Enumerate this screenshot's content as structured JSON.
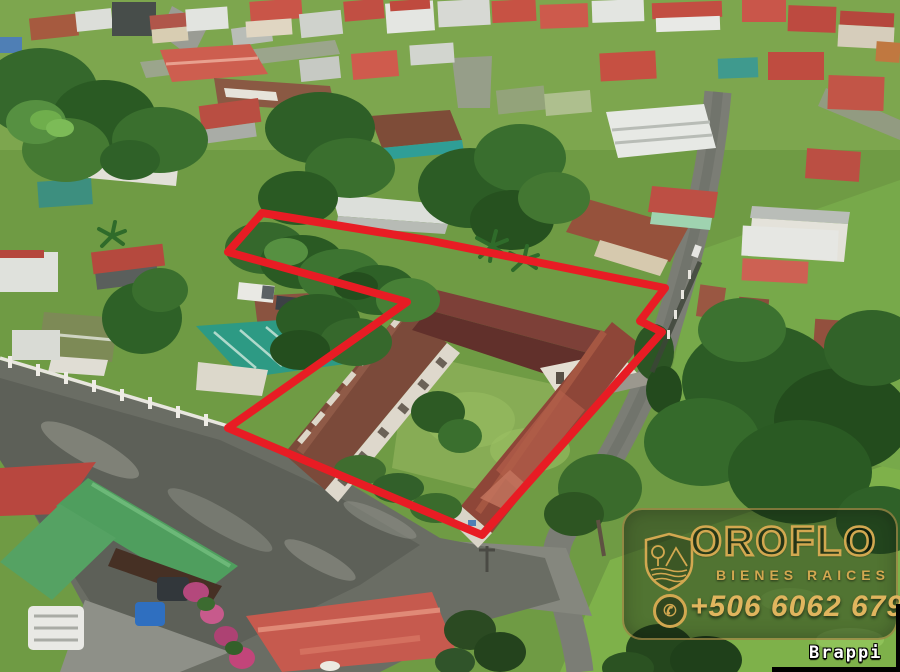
{
  "scene": {
    "type": "aerial-drone-photo",
    "description": "Aerial view of a town; a large commercial property with long rust-roofed buildings is outlined in red; roads, houses and tropical vegetation surround it."
  },
  "colors": {
    "boundary-red": "#e81c24",
    "gold": "#d2a850",
    "gold-bright": "#e0b55e"
  },
  "watermark": {
    "brand": "OROFLO",
    "tagline": "BIENES RAICES",
    "phone": "+506 6062 6795"
  },
  "footer": {
    "credit": "Brappi"
  }
}
